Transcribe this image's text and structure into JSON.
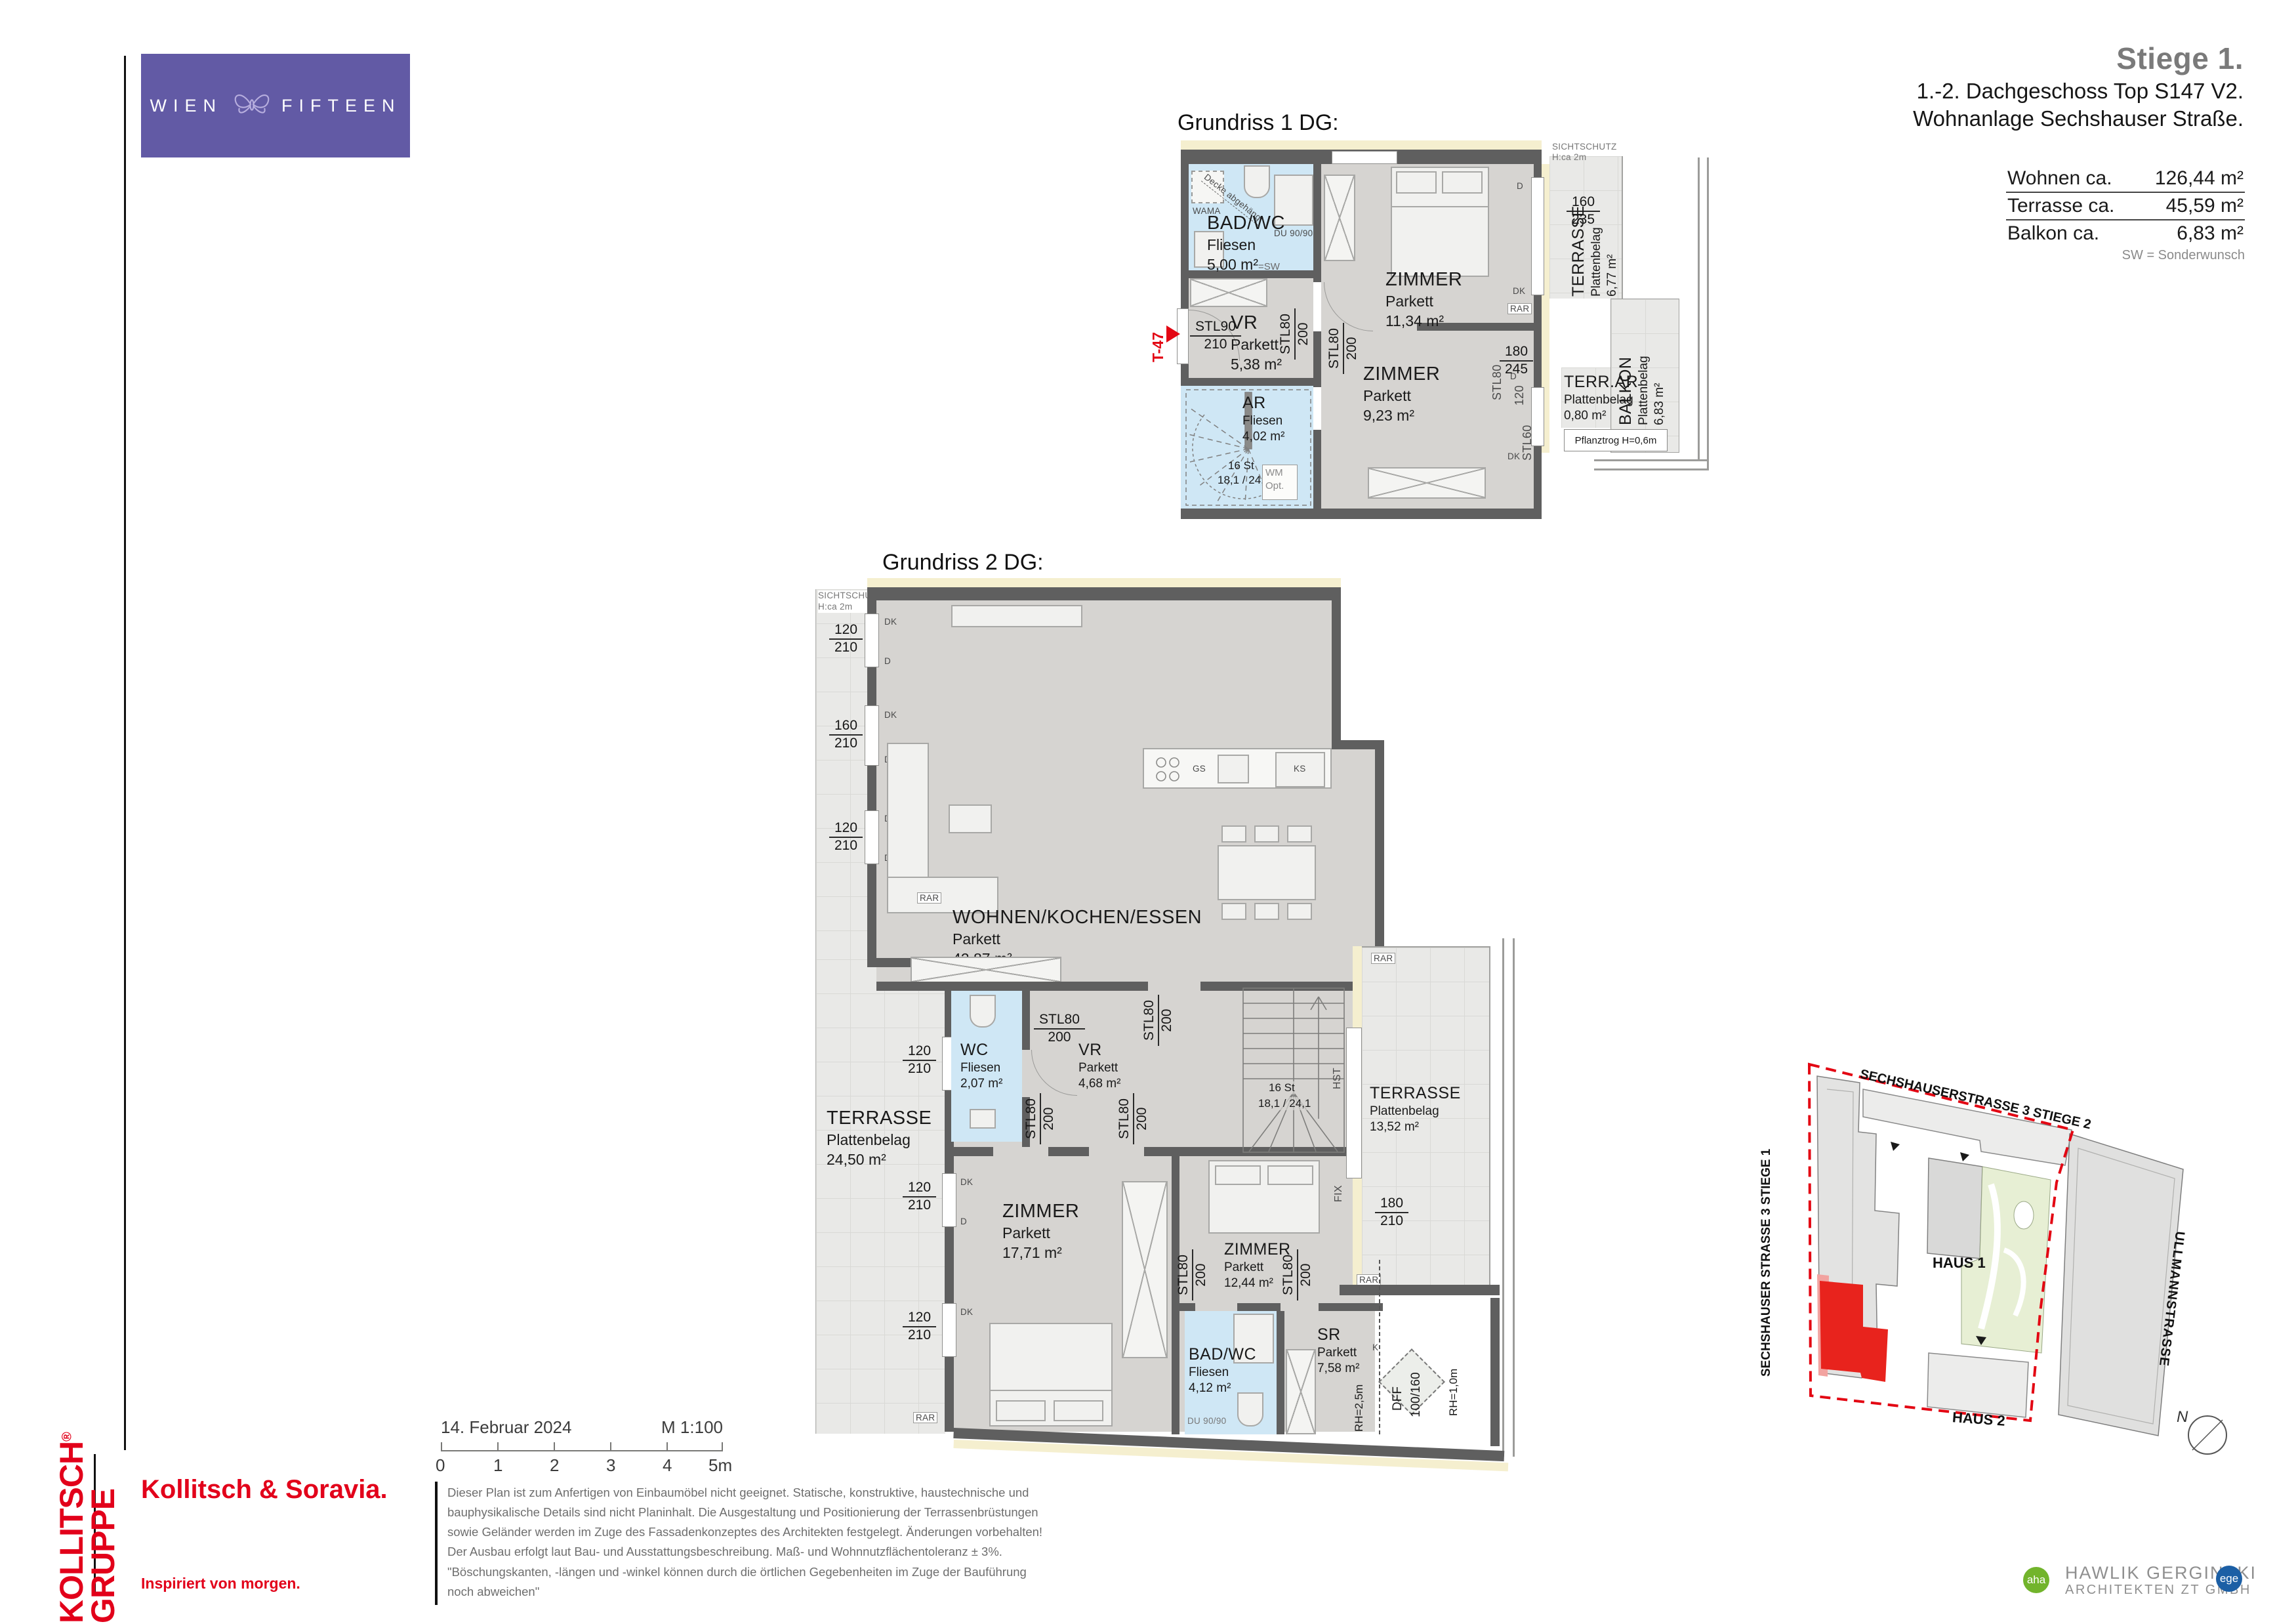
{
  "colors": {
    "accent_red": "#e30613",
    "brand_red": "#e2001a",
    "logo_purple": "#625aa5",
    "aha_green": "#72b42c",
    "ege_blue": "#1c5fa5",
    "wetroom_blue": "#cfe7f5",
    "site_unit_red": "#e8231d"
  },
  "brand": {
    "left": "WIEN",
    "right": "FIFTEEN"
  },
  "header": {
    "title": "Stiege 1.",
    "line1": "1.-2. Dachgeschoss Top S147 V2.",
    "line2": "Wohnanlage Sechshauser Straße.",
    "areas": [
      {
        "label": "Wohnen ca.",
        "value": "126,44 m²"
      },
      {
        "label": "Terrasse ca.",
        "value": "45,59 m²"
      },
      {
        "label": "Balkon ca.",
        "value": "6,83 m²"
      }
    ],
    "note": "SW = Sonderwunsch"
  },
  "common": {
    "stl80": "STL80",
    "stl90": "STL90",
    "stl60": "STL60",
    "n200": "200",
    "n210": "210",
    "n120": "120",
    "n160": "160",
    "n235": "235",
    "n180": "180",
    "n245": "245",
    "rar": "RAR",
    "d": "D",
    "dk": "DK",
    "du": "DU 90/90",
    "sichtschutz": "SICHTSCHUTZ",
    "sichtschutz_h": "H:ca 2m",
    "steps_count": "16 St",
    "steps_dim": "18,1 / 24,1"
  },
  "plan1": {
    "title": "Grundriss 1 DG:",
    "t47": "T-47",
    "wama": "WAMA",
    "decke": "Decke abgehängt",
    "wm": "WM",
    "opt": "Opt.",
    "pflanztrog": "Pflanztrog H=0,6m",
    "rooms": {
      "bad": {
        "name": "BAD/WC",
        "floor": "Fliesen",
        "area": "5,00 m²",
        "suffix": "=SW"
      },
      "vr": {
        "name": "VR",
        "floor": "Parkett",
        "area": "5,38 m²"
      },
      "ar": {
        "name": "AR",
        "floor": "Fliesen",
        "area": "4,02 m²"
      },
      "zimmer_gross": {
        "name": "ZIMMER",
        "floor": "Parkett",
        "area": "11,34 m²"
      },
      "zimmer_klein": {
        "name": "ZIMMER",
        "floor": "Parkett",
        "area": "9,23 m²"
      },
      "terrasse": {
        "name": "TERRASSE",
        "floor": "Plattenbelag",
        "area": "6,77 m²"
      },
      "balkon": {
        "name": "BALKON",
        "floor": "Plattenbelag",
        "area": "6,83 m²"
      },
      "terrar": {
        "name": "TERR.AR",
        "floor": "Plattenbelag",
        "area": "0,80 m²"
      }
    }
  },
  "plan2": {
    "title": "Grundriss 2 DG:",
    "gelaender": "GELÄNDER",
    "hst": "HST",
    "fix": "FIX",
    "gs": "GS",
    "ks": "KS",
    "dff": "DFF",
    "dff_size": "100/160",
    "rh1": "RH=1,0m",
    "rh25": "RH=2,5m",
    "k": "K",
    "rooms": {
      "wohnen": {
        "name": "WOHNEN/KOCHEN/ESSEN",
        "floor": "Parkett",
        "area": "42,87 m²"
      },
      "wc": {
        "name": "WC",
        "floor": "Fliesen",
        "area": "2,07 m²"
      },
      "vr": {
        "name": "VR",
        "floor": "Parkett",
        "area": "4,68 m²"
      },
      "terrasse_links": {
        "name": "TERRASSE",
        "floor": "Plattenbelag",
        "area": "24,50 m²"
      },
      "terrasse_rechts": {
        "name": "TERRASSE",
        "floor": "Plattenbelag",
        "area": "13,52 m²"
      },
      "zimmer_links": {
        "name": "ZIMMER",
        "floor": "Parkett",
        "area": "17,71 m²"
      },
      "zimmer_rechts": {
        "name": "ZIMMER",
        "floor": "Parkett",
        "area": "12,44 m²"
      },
      "bad": {
        "name": "BAD/WC",
        "floor": "Fliesen",
        "area": "4,12 m²"
      },
      "sr": {
        "name": "SR",
        "floor": "Parkett",
        "area": "7,58 m²"
      }
    }
  },
  "site": {
    "street_top": "SECHSHAUSERSTRASSE 3 STIEGE 2",
    "street_left": "SECHSHAUSER STRASSE 3 STIEGE 1",
    "street_right": "ULLMANNSTRASSE",
    "haus1": "HAUS 1",
    "haus2": "HAUS 2",
    "north": "N"
  },
  "footer": {
    "date": "14. Februar 2024",
    "scale": "M 1:100",
    "ticks": [
      "0",
      "1",
      "2",
      "3",
      "4",
      "5m"
    ],
    "disclaimer": [
      "Dieser Plan ist zum Anfertigen von Einbaumöbel nicht geeignet. Statische,  konstruktive, haustechnische und",
      "bauphysikalische Details sind nicht Planinhalt. Die Ausgestaltung und Positionierung der Terrassenbrüstungen",
      "sowie Geländer werden im Zuge des Fassadenkonzeptes des Architekten festgelegt. Änderungen vorbehalten!",
      "Der Ausbau erfolgt laut Bau- und Ausstattungsbeschreibung. Maß- und Wohnnutzflächentoleranz ± 3%.",
      "\"Böschungskanten, -längen und -winkel können durch die örtlichen Gegebenheiten im Zuge der Bauführung",
      "noch abweichen\""
    ],
    "kollitsch": "KOLLITSCH",
    "reg": "®",
    "gruppe": "GRUPPE",
    "soravia": "Kollitsch & Soravia.",
    "tagline": "Inspiriert von morgen.",
    "arch1": "HAWLIK GERGINSKI",
    "arch2": "ARCHITEKTEN ZT GMBH",
    "aha": "aha",
    "ege": "ege"
  }
}
